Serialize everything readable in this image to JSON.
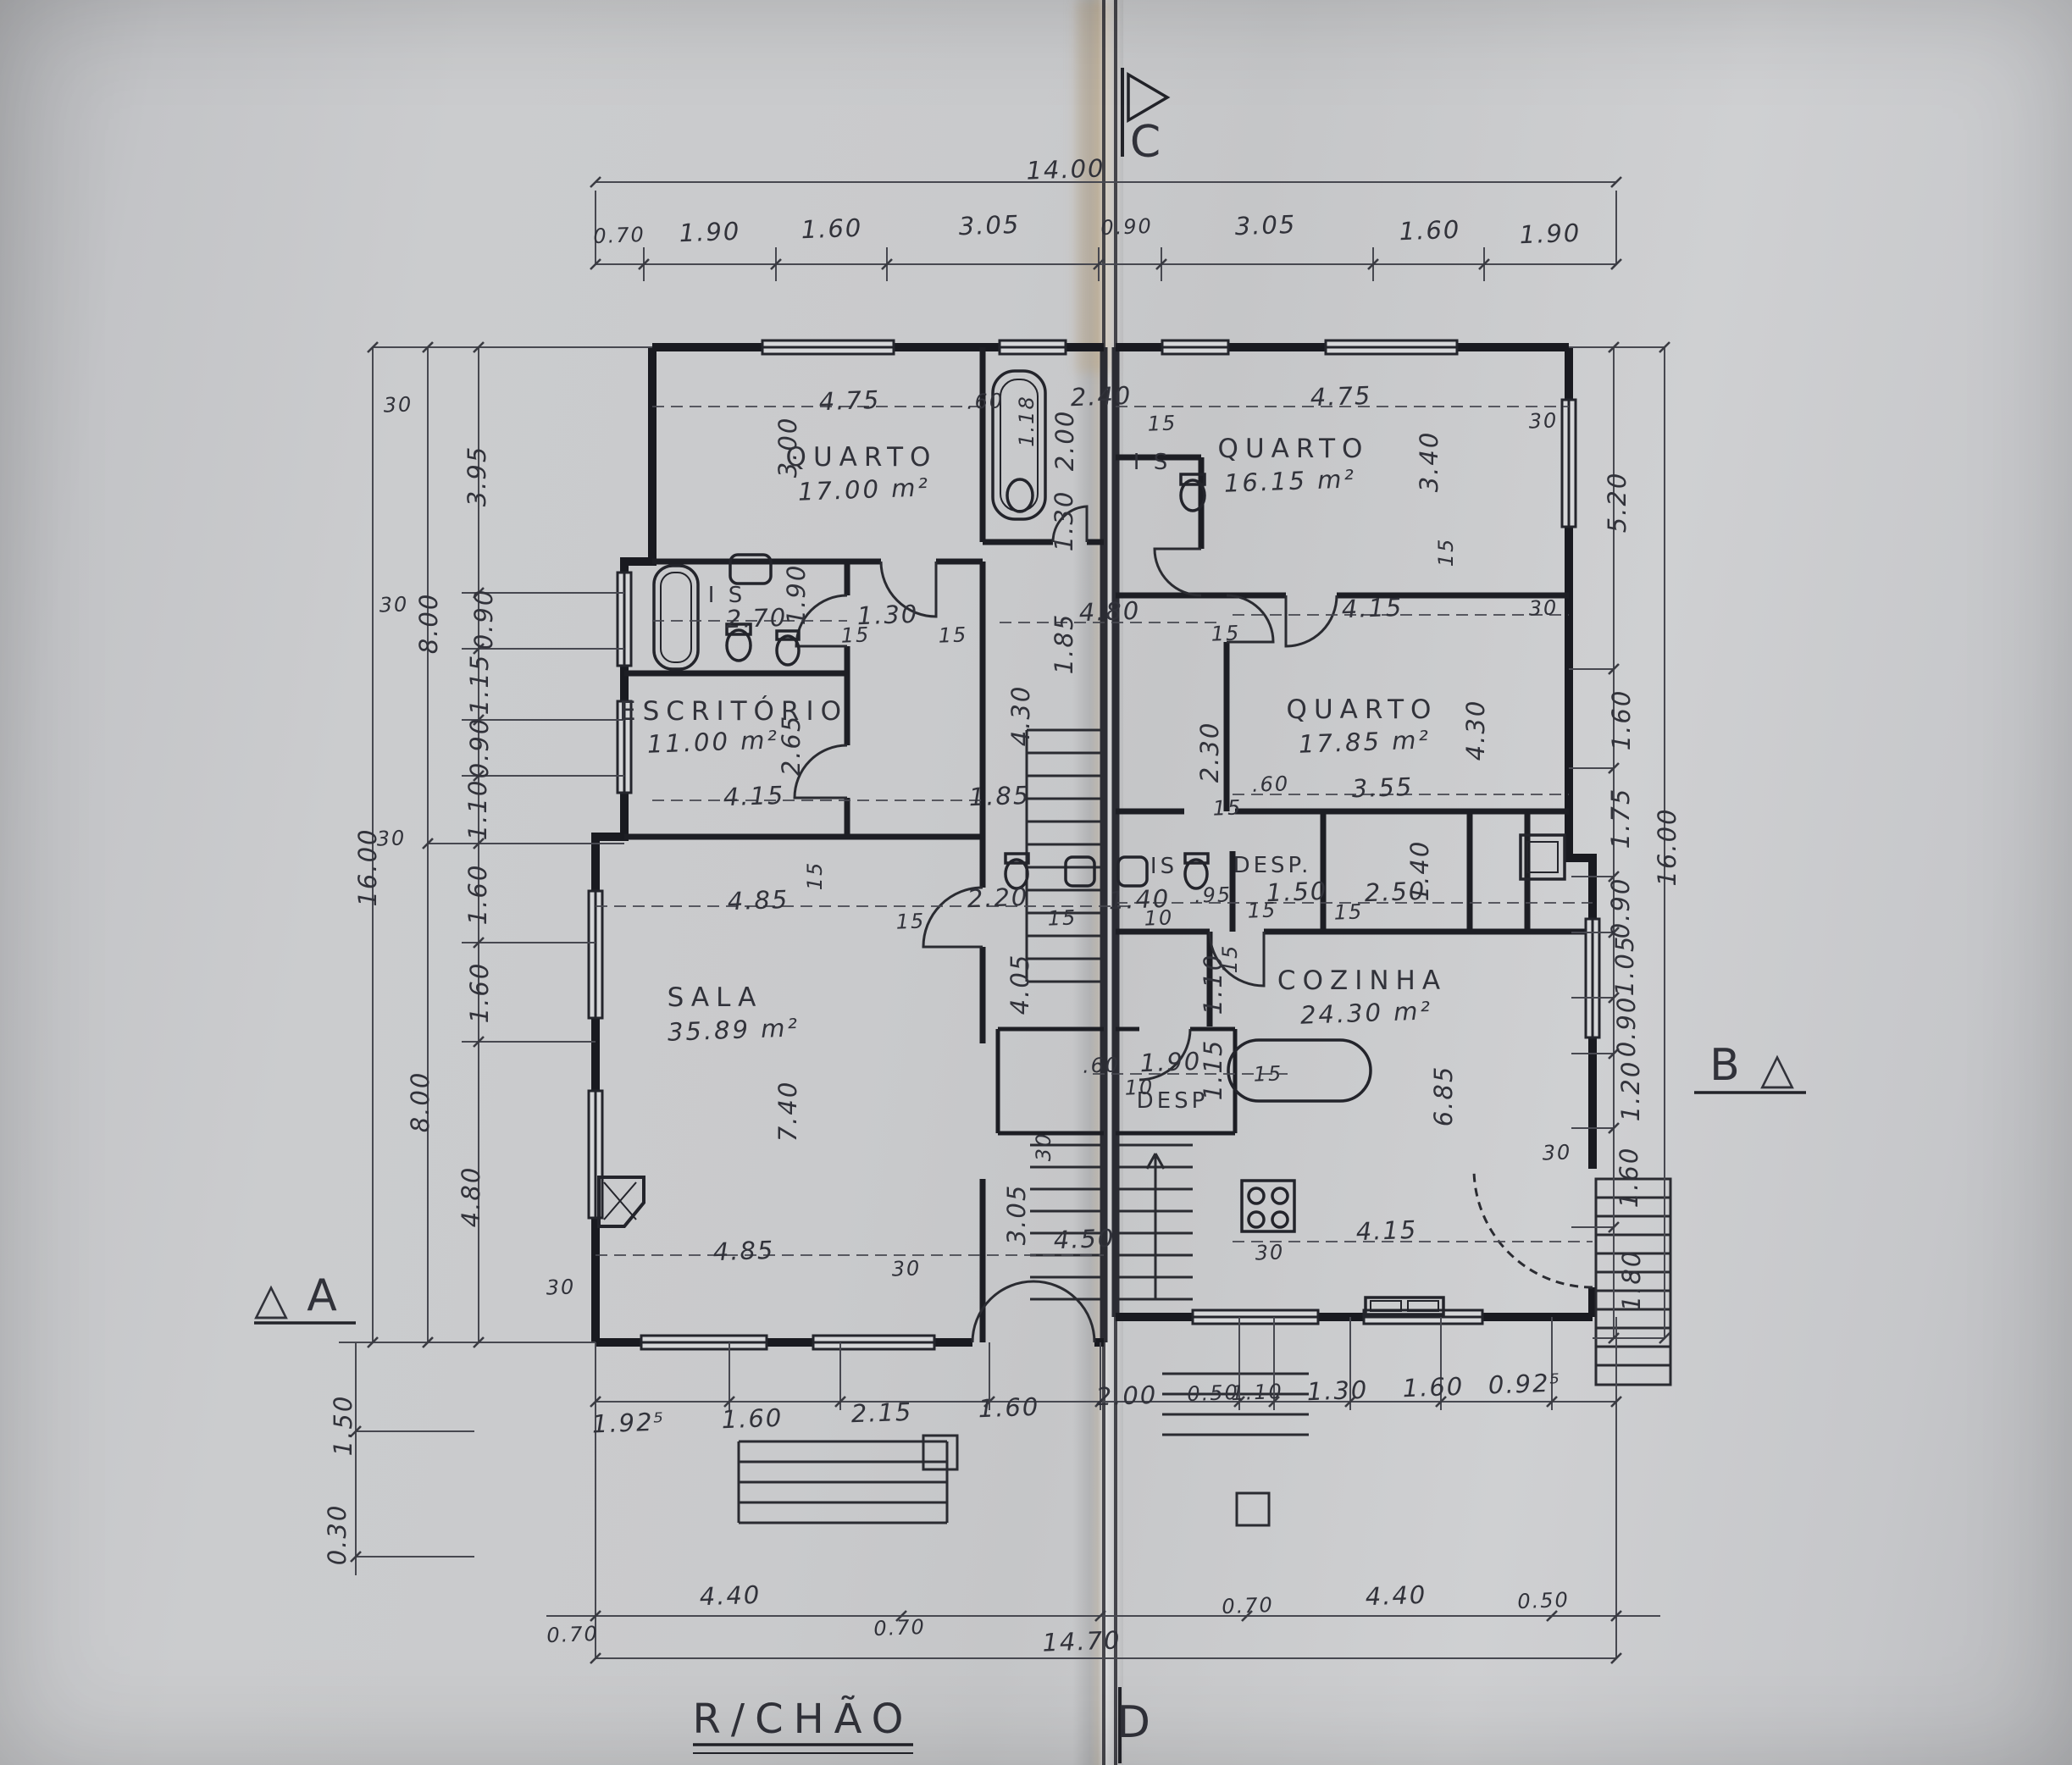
{
  "title": {
    "text": "R/CHÃO"
  },
  "markers": {
    "a": "A",
    "b": "B",
    "c": "C",
    "d": "D",
    "tri": "△"
  },
  "rooms": {
    "quarto1": {
      "name": "QUARTO",
      "area": "17.00 m²"
    },
    "quarto2": {
      "name": "QUARTO",
      "area": "16.15 m²"
    },
    "quarto3": {
      "name": "QUARTO",
      "area": "17.85 m²"
    },
    "escritorio": {
      "name": "ESCRITÓRIO",
      "area": "11.00 m²"
    },
    "sala": {
      "name": "SALA",
      "area": "35.89 m²"
    },
    "cozinha": {
      "name": "COZINHA",
      "area": "24.30 m²"
    },
    "desp_upper": "DESP.",
    "desp_lower": "DESP",
    "is_left": "I S",
    "is_mid": "IS",
    "is_top": "I S"
  },
  "dims": {
    "v": {
      "n1400": "14.00",
      "n1470": "14.70",
      "n1600": "16.00",
      "n070": "0.70",
      "n190": "1.90",
      "n160": "1.60",
      "n305": "3.05",
      "n090": "0.90",
      "n475": "4.75",
      "n300": "3.00",
      "n240": "2.40",
      "n200": "2.00",
      "n130": "1.30",
      "n118": "1.18",
      "n270": "2.70",
      "n265": "2.65",
      "n415": "4.15",
      "n185": "1.85",
      "n480": "4.80",
      "n430": "4.30",
      "n230": "2.30",
      "n340": "3.40",
      "n355": "3.55",
      "n140": "1.40",
      "n095": ".95",
      "n150": "1.50",
      "n250": "2.50",
      "n110": "1.10",
      "n115": "1.15",
      "n220": "2.20",
      "n405": "4.05",
      "n485": "4.85",
      "n740": "7.40",
      "n450": "4.50",
      "n685": "6.85",
      "n520": "5.20",
      "n175": "1.75",
      "n105": "1.05",
      "n120": "1.20",
      "n180": "1.80",
      "n395": "3.95",
      "n800": "8.00",
      "n030": "0.30",
      "n1925": "1.92⁵",
      "n215": "2.15",
      "n050": "0.50",
      "n0925": "0.92⁵",
      "n440": "4.40",
      "thk30": "30",
      "thk15": "15",
      "thk10": "10",
      "thk60": ".60"
    }
  }
}
